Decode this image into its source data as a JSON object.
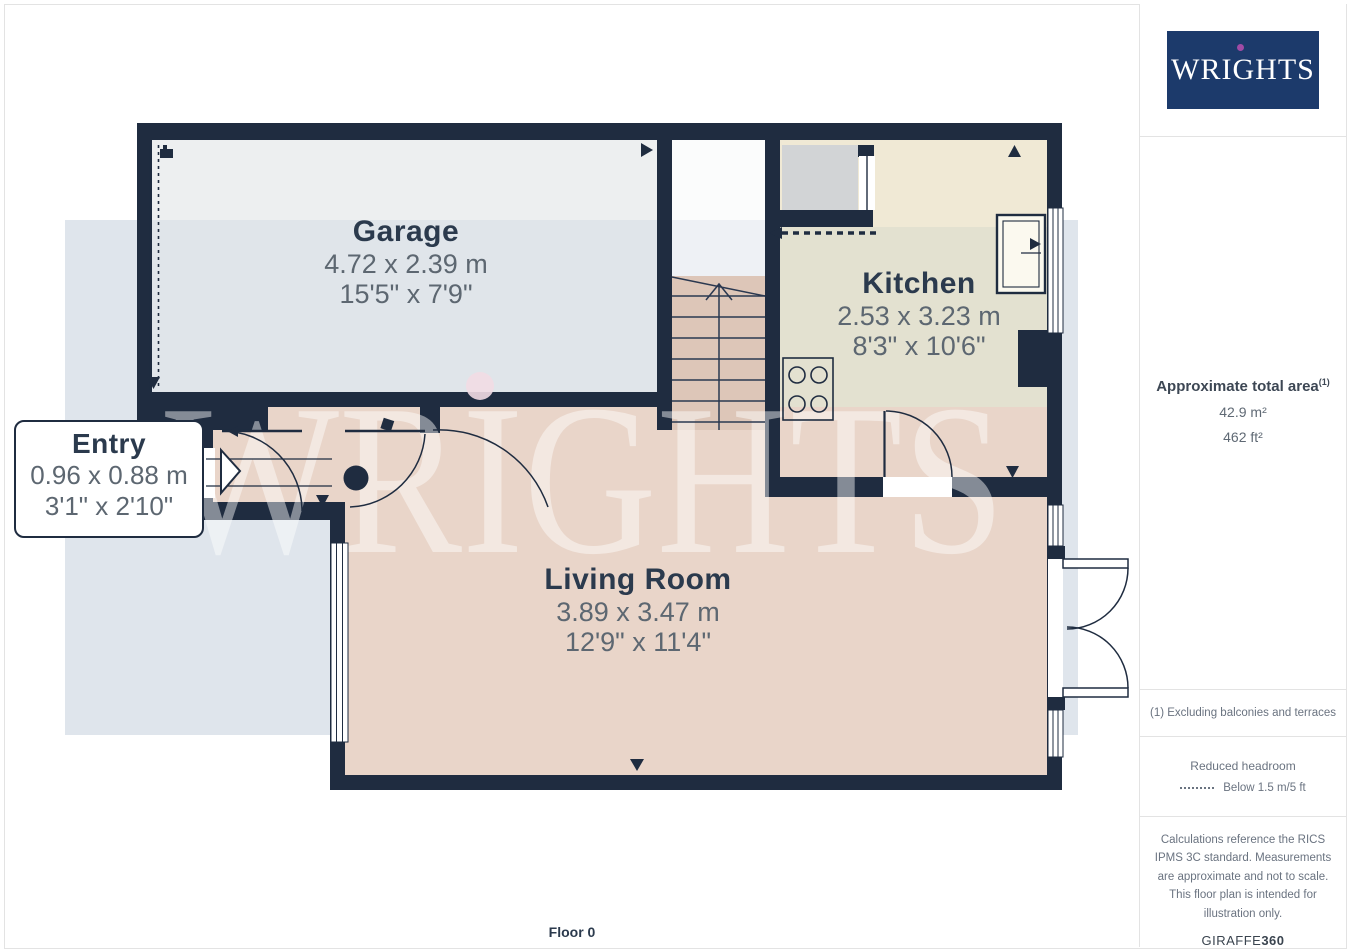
{
  "logo": {
    "text": "WRIGHTS"
  },
  "floorplan": {
    "floor_label": "Floor 0",
    "watermark": "WRIGHTS",
    "rooms": [
      {
        "name": "Garage",
        "metric": "4.72 x 2.39 m",
        "imperial": "15'5\" x 7'9\""
      },
      {
        "name": "Kitchen",
        "metric": "2.53 x 3.23 m",
        "imperial": "8'3\" x 10'6\""
      },
      {
        "name": "Entry",
        "metric": "0.96 x 0.88 m",
        "imperial": "3'1\" x 2'10\""
      },
      {
        "name": "Living Room",
        "metric": "3.89 x 3.47 m",
        "imperial": "12'9\" x 11'4\""
      }
    ]
  },
  "sidebar": {
    "area": {
      "title": "Approximate total area",
      "footnote_marker": "(1)",
      "metric": "42.9 m²",
      "imperial": "462 ft²"
    },
    "footnote": "(1) Excluding balconies and terraces",
    "reduced_headroom": {
      "title": "Reduced headroom",
      "legend": "Below 1.5 m/5 ft"
    },
    "disclaimer": "Calculations reference the RICS IPMS 3C standard. Measurements are approximate and not to scale. This floor plan is intended for illustration only.",
    "brand": {
      "giraffe": "GIRAFFE",
      "threesixty": "360"
    }
  },
  "colors": {
    "wall": "#1f2c40",
    "logo_navy": "#1c3a6b",
    "logo_dot": "#a04ba5",
    "floor_pink": "#e9d5c9",
    "floor_stairs": "#ddc6b8",
    "floor_kitchen": "#e3e1d0",
    "floor_kitchen_light": "#f0e9d5",
    "floor_garage": "#edeff0",
    "background_blue": "#dfe5ec"
  }
}
